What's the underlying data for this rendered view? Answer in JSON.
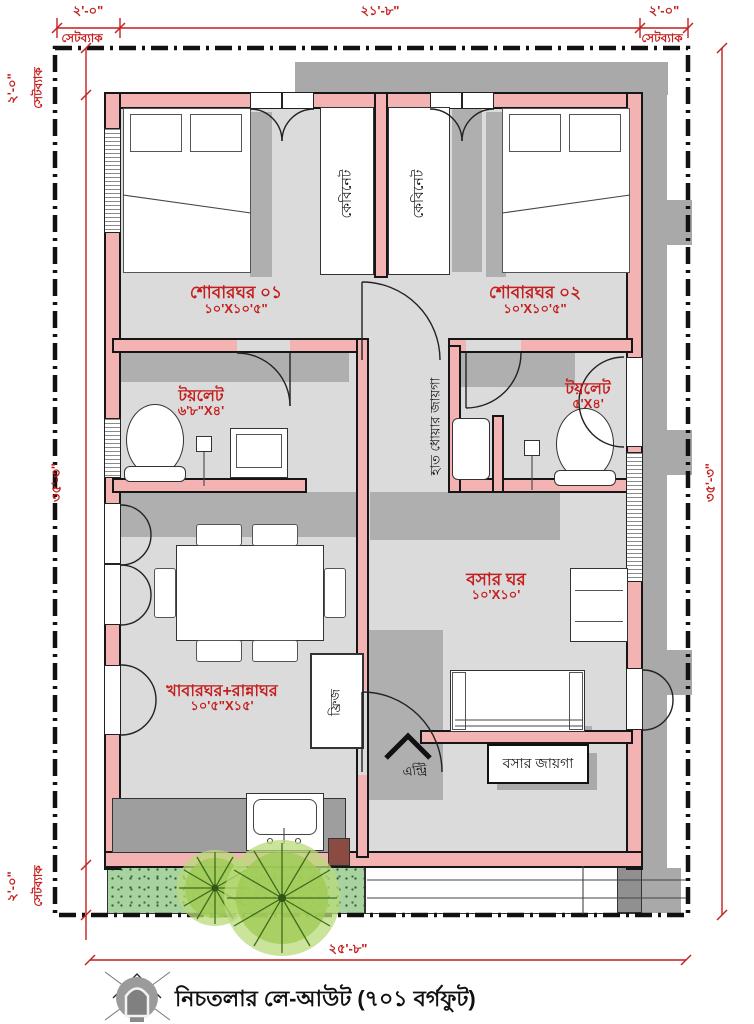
{
  "dims": {
    "setback": "সেটব্যাক",
    "two_feet": "২'-০\"",
    "top_width": "২১'-৮\"",
    "bottom_width": "২৫'-৮\"",
    "side_height": "৩৫'-৩\""
  },
  "rooms": {
    "bedroom1": {
      "name": "শোবারঘর ০১",
      "size": "১০'X১০'৫\""
    },
    "bedroom2": {
      "name": "শোবারঘর ০২",
      "size": "১০'X১০'৫\""
    },
    "toilet1": {
      "name": "টয়লেট",
      "size": "৬'৮\"X৪'"
    },
    "toilet2": {
      "name": "টয়লেট",
      "size": "৫'X৪'"
    },
    "living": {
      "name": "বসার ঘর",
      "size": "১০'X১০'"
    },
    "dining": {
      "name": "খাবারঘর+রান্নাঘর",
      "size": "১০'৫\"X১৫'"
    }
  },
  "labels": {
    "cabinet": "কেবিনেট",
    "handwash": "হাত ধোয়ার জায়গা",
    "fridge": "ফ্রিজ",
    "entry": "এন্ট্রি",
    "sitting": "বসার জায়গা"
  },
  "footer": {
    "caption": "নিচতলার লে-আউট (৭০১ বর্গফুট)"
  },
  "colors": {
    "wall_pink": "#F3B3B3",
    "dimension_red": "#C41E1E",
    "floor_gray": "#DBDBDB",
    "shadow_gray": "#A9A9A9",
    "grass_green": "#A8D2A0",
    "tree_green": "#8FBF4A"
  }
}
